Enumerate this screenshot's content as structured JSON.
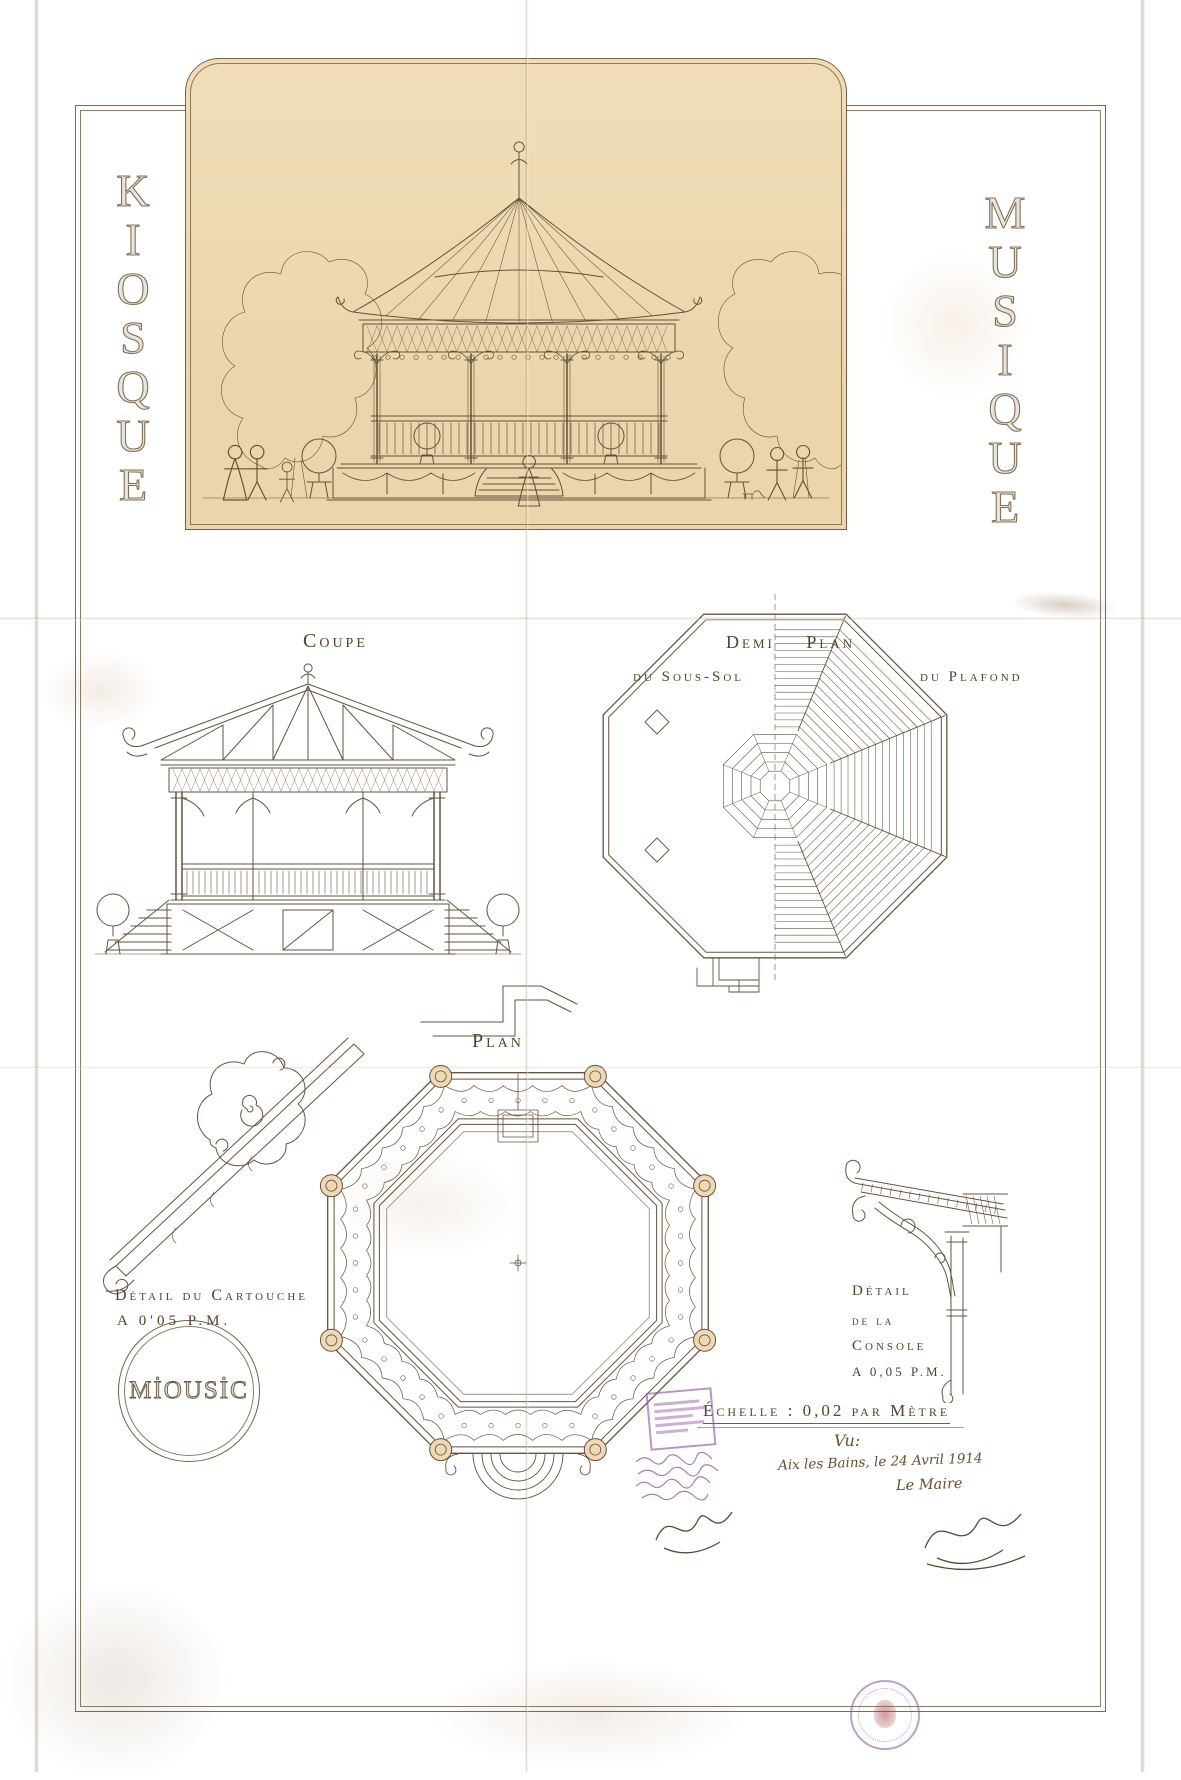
{
  "sheet": {
    "side_titles": {
      "left_word": "KIOSQUE",
      "right_word": "MUSIQUE",
      "left_letters": [
        "K",
        "I",
        "O",
        "S",
        "Q",
        "U",
        "E"
      ],
      "right_letters": [
        "M",
        "U",
        "S",
        "I",
        "Q",
        "U",
        "E"
      ]
    },
    "sections": {
      "coupe": {
        "label": "Coupe"
      },
      "demi_plan": {
        "title": "Demi Plan",
        "left_label": "du Sous-Sol",
        "right_label": "du Plafond"
      },
      "plan": {
        "label": "Plan"
      },
      "cartouche_detail": {
        "title": "Détail du Cartouche",
        "scale": "A 0'05 P.M."
      },
      "console_detail": {
        "title_line1": "Détail",
        "title_line2": "de la",
        "title_line3": "Console",
        "scale": "A 0,05 P.M."
      }
    },
    "logo_text": "MİOUSİC",
    "scale_note": "Échelle : 0,02 par Mètre",
    "approval": {
      "vu": "Vu:",
      "place_date": "Aix les Bains, le 24 Avril 1914",
      "signatory": "Le Maire"
    },
    "stamps": {
      "rectangular": "illegible-purple-office-stamp",
      "round": "illegible-purple-round-seal"
    },
    "colors": {
      "paper": "#ebd3aa",
      "ink": "#5a472f",
      "stamp_purple": "#8b4fa0"
    }
  }
}
